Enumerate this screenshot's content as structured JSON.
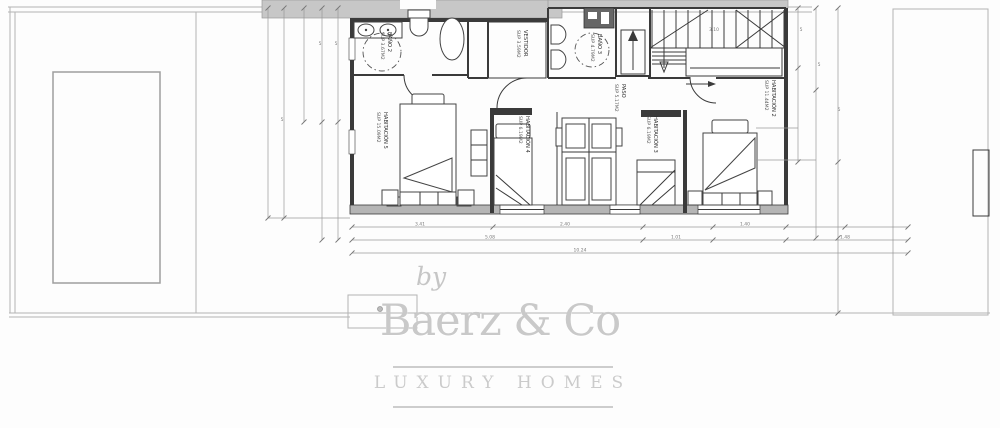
{
  "watermark": {
    "by": "by",
    "brand": "Baerz & Co",
    "tagline": "LUXURY HOMES"
  },
  "rooms": [
    {
      "id": "bano2",
      "name": "BAÑO 2",
      "area": "SUP 3.67M2"
    },
    {
      "id": "vestidor",
      "name": "VESTIDOR",
      "area": "SUP 3.59M2"
    },
    {
      "id": "bano3",
      "name": "BAÑO 3",
      "area": "SUP 4.79M2"
    },
    {
      "id": "paso",
      "name": "PASO",
      "area": "SUP 5.17M2"
    },
    {
      "id": "habitacion5",
      "name": "HABITACIÓN 5",
      "area": "SUP 15.09M2"
    },
    {
      "id": "habitacion4",
      "name": "HABITACIÓN 4",
      "area": "SUP 6.19M2"
    },
    {
      "id": "habitacion3",
      "name": "HABITACIÓN 3",
      "area": "SUP 6.19M2"
    },
    {
      "id": "habitacion2",
      "name": "HABITACIÓN 2",
      "area": "SUP 11.44M2"
    }
  ],
  "dims": {
    "tick": "5",
    "stair": "3.10",
    "bottom_row1": [
      "3.41",
      "2.40",
      "1.40"
    ],
    "bottom_row2": [
      "5.08",
      "1.01",
      "1.48"
    ],
    "bottom_total": "10.24"
  },
  "colors": {
    "wall_dark": "#3a3a3a",
    "wall_gray_band": "#c7c7c7",
    "site_line": "#b3b3b3",
    "dimension_line": "#999999",
    "watermark_gray": "#c9c9c9"
  }
}
